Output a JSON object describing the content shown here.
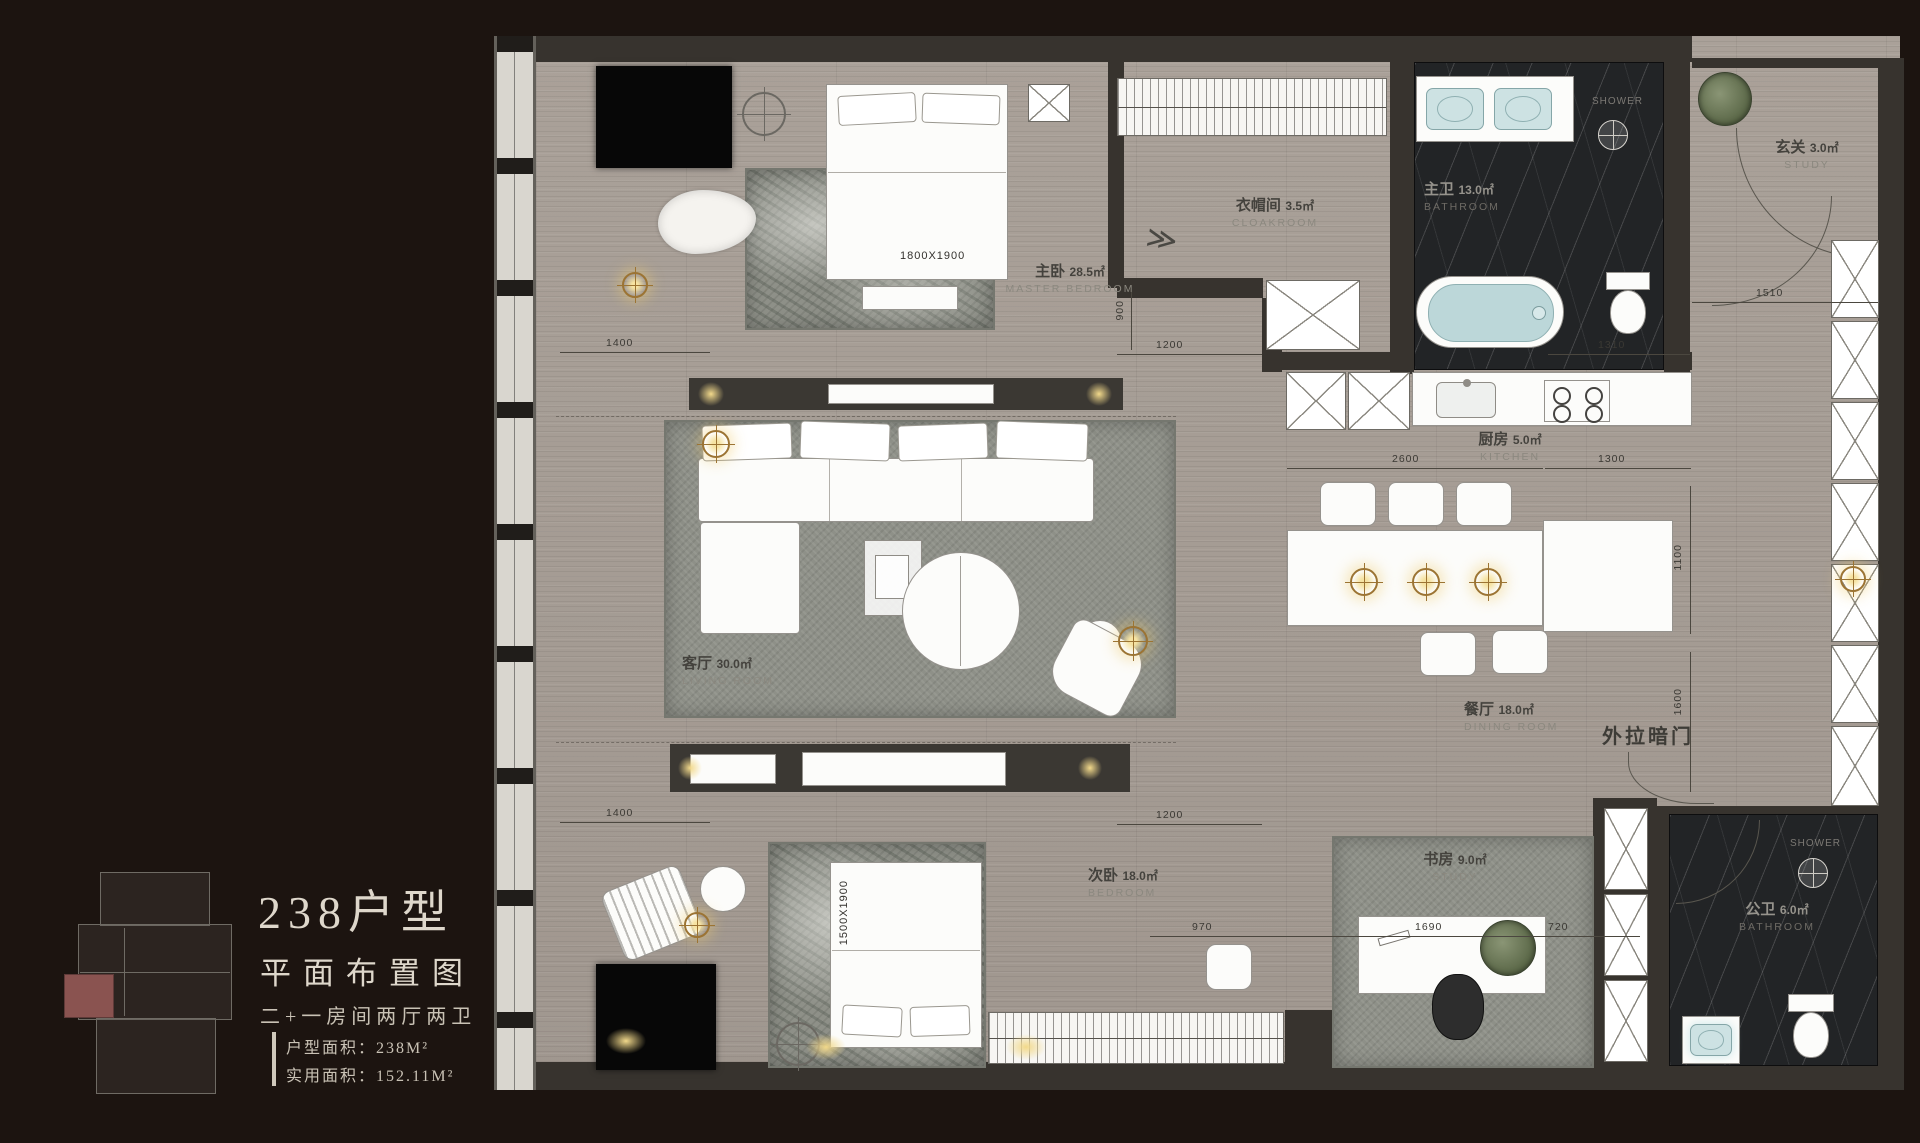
{
  "panel": {
    "title": "238户型",
    "subtitle": "平面布置图",
    "spec": "二+一房间两厅两卫",
    "gross_area": "户型面积：238M²",
    "net_area": "实用面积：152.11M²"
  },
  "rooms": {
    "master_bedroom": {
      "cn": "主卧",
      "area": "28.5㎡",
      "en": "MASTER BEDROOM"
    },
    "cloakroom": {
      "cn": "衣帽间",
      "area": "3.5㎡",
      "en": "CLOAKROOM"
    },
    "master_bath": {
      "cn": "主卫",
      "area": "13.0㎡",
      "en": "BATHROOM"
    },
    "entry": {
      "cn": "玄关",
      "area": "3.0㎡",
      "en": "STUDY"
    },
    "living": {
      "cn": "客厅",
      "area": "30.0㎡",
      "en": "LIVING ROOM"
    },
    "kitchen": {
      "cn": "厨房",
      "area": "5.0㎡",
      "en": "KITCHEN"
    },
    "dining": {
      "cn": "餐厅",
      "area": "18.0㎡",
      "en": "DINING ROOM"
    },
    "bedroom2": {
      "cn": "次卧",
      "area": "18.0㎡",
      "en": "BEDROOM"
    },
    "study": {
      "cn": "书房",
      "area": "9.0㎡",
      "en": "STUDY"
    },
    "public_bath": {
      "cn": "公卫",
      "area": "6.0㎡",
      "en": "BATHROOM"
    }
  },
  "annotations": {
    "shower_master": "SHOWER",
    "shower_public": "SHOWER",
    "hidden_door": "外拉暗门",
    "bed_master_size": "1800X1900",
    "bed_second_size": "1500X1900"
  },
  "dimensions": {
    "top_left": "1400",
    "top_mid": "1200",
    "top_vert": "900",
    "top_right": "1510",
    "right_upper": "1310",
    "kitchen_left": "2600",
    "kitchen_right": "1300",
    "right_mid_vert": "1100",
    "right_low_vert": "1600",
    "bottom_left": "1400",
    "bottom_mid": "1200",
    "desk_left": "970",
    "desk_width": "1690",
    "desk_right": "720"
  },
  "icons": {
    "chevron": "≫"
  },
  "colors": {
    "background": "#1c1410",
    "floor": "#a59c94",
    "wall": "#37332e",
    "marble": "#222426",
    "rug": "#8e9088",
    "unit_highlight": "#8a5350",
    "water": "#c2dcdd",
    "glow": "#f2d98b"
  }
}
